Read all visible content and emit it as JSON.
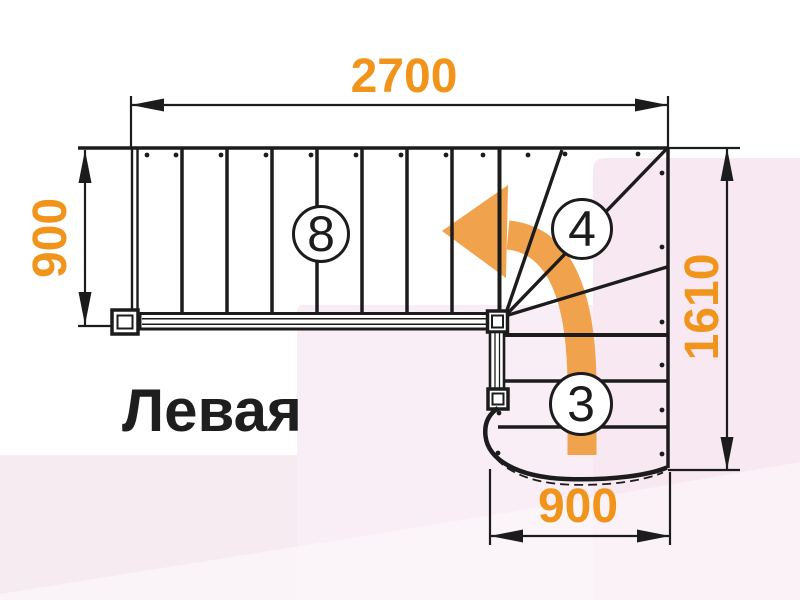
{
  "title": {
    "label": "Левая"
  },
  "diagram": {
    "type": "staircase-floor-plan",
    "dimensions": {
      "top_width_mm": "2700",
      "left_depth_mm": "900",
      "right_height_mm": "1610",
      "bottom_width_mm": "900"
    },
    "step_counts": {
      "upper_flight": "8",
      "winders": "4",
      "lower_flight": "3"
    },
    "colors": {
      "dimension_text": "#F0941C",
      "direction_arrow": "#F0A24D",
      "linework": "#1C1C1C",
      "background_tint": "#F7E8F1"
    },
    "arrow_meaning": "direction of travel: up the lower flight, turning left across the winders"
  }
}
